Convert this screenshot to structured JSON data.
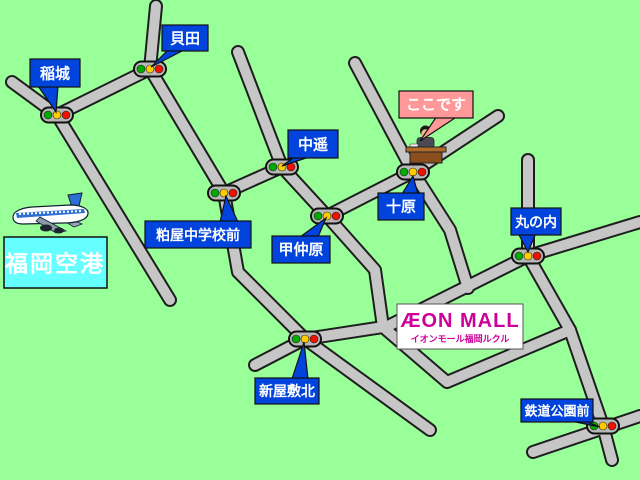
{
  "title": "イオンモール福岡ルクル アクセスマップ",
  "colors": {
    "background": "#99ff99",
    "road_surface": "#c6c6c6",
    "road_outline": "#1e1e1e",
    "label_bubble": "#0044dd",
    "label_text": "#ffffff",
    "here_bubble": "#ff9999",
    "here_text": "#ffaa00",
    "airport_box": "#66ffff",
    "airport_text": "#ffffff",
    "aeon_magenta": "#cc0099",
    "signal_green": "#00aa00",
    "signal_yellow": "#ffcc00",
    "signal_red": "#ee1100"
  },
  "intersections": [
    {
      "id": "inagi",
      "name": "稲城"
    },
    {
      "id": "kaida",
      "name": "貝田"
    },
    {
      "id": "nakahara",
      "name": "中遥"
    },
    {
      "id": "kasuya_jhs_mae",
      "name": "粕屋中学校前"
    },
    {
      "id": "konakabaru",
      "name": "甲仲原"
    },
    {
      "id": "jubaru",
      "name": "十原"
    },
    {
      "id": "marunouchi",
      "name": "丸の内"
    },
    {
      "id": "shinyashiki_kita",
      "name": "新屋敷北"
    },
    {
      "id": "tetsudo_koen_mae",
      "name": "鉄道公園前"
    }
  ],
  "callouts": {
    "here": "ここです",
    "airport": "福岡空港"
  },
  "aeon": {
    "logo": "ÆON MALL",
    "subtitle": "イオンモール福岡ルクル"
  }
}
